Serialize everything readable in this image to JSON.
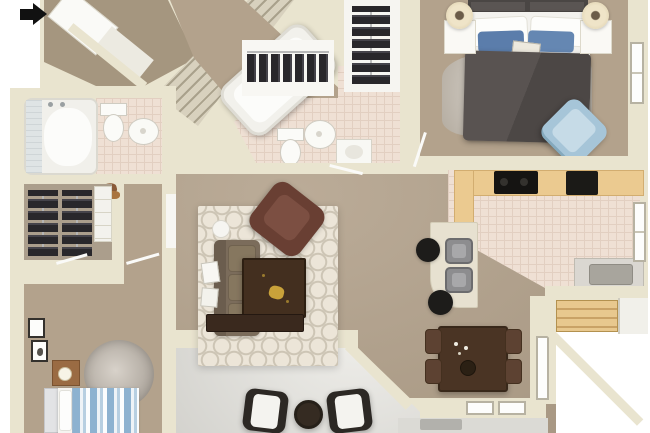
{
  "image": {
    "type": "3d-floor-plan",
    "description": "Top-down 3D architectural rendering of an apartment floor plan; no text labels visible",
    "visible_text": "none"
  },
  "icons": {
    "entry_arrow": "solid black right-pointing arrow marking the unit entry at top-left"
  },
  "palette": {
    "wall": "#e9e4cf",
    "wall_shade": "#d6cfb6",
    "white_wall": "#f7f6f2",
    "carpet": "#b3a28c",
    "carpet_dark": "#a5967f",
    "tile": "#efe0d4",
    "tile_line": "#e2cfc1",
    "patio": "#c9c8c3",
    "wood_counter": "#ebca90",
    "wood_steps": "#e8c88e",
    "dark_wood": "#43301f",
    "duvet": "#555050",
    "pillow_blue": "#5b7dab",
    "chair_blue": "#a6c5d8",
    "sofa": "#7b6c5b",
    "armchair": "#693f33",
    "rug_cream": "#ece5d8",
    "rug_pattern": "#cdc5b5",
    "shag": "#c6bfb7",
    "clothes": "#29272b",
    "appliance": "#151412",
    "arrow": "#111111",
    "glass": "#d9e3e7"
  },
  "rooms": {
    "entry": {
      "label": "Entry"
    },
    "staircase": {
      "label": "Staircase"
    },
    "hallway": {
      "label": "Hallway"
    },
    "closet_a": {
      "label": "Closet with hanging clothes"
    },
    "closet_b": {
      "label": "Closet with hanging clothes"
    },
    "bathroom_upper": {
      "label": "Bathroom with tub, toilet and sinks"
    },
    "master_bedroom": {
      "label": "Bedroom with queen bed and blue chair"
    },
    "kitchen": {
      "label": "Kitchen with wood counters"
    },
    "living_room": {
      "label": "Living room"
    },
    "bathroom_left": {
      "label": "Bathroom with tub, toilet and sink"
    },
    "walk_in_closet": {
      "label": "Walk-in closet"
    },
    "bedroom_2": {
      "label": "Bedroom with striped twin bed"
    },
    "patio": {
      "label": "Patio with two chairs and table"
    },
    "dining_area": {
      "label": "Dining area with table for four"
    },
    "exterior_steps": {
      "label": "Exterior wood steps"
    }
  },
  "furniture": {
    "master_bed": "Bed with dark gray duvet and blue pillows",
    "blue_chair": "Light blue accent chair",
    "shag_rug": "Light gray shag rug",
    "cooktop": "Black cooktop",
    "breakfast_bar": "Breakfast bar with two stools",
    "sofa": "Brown three-seat sofa",
    "armchair": "Dark red-brown armchair",
    "coffee_table": "Dark wood coffee table",
    "trellis_rug": "Cream trellis-pattern area rug",
    "tv_stand": "Dark wood media stand",
    "dining_table": "Dark wood dining table with four chairs",
    "twin_bed": "Blue and white striped twin bed",
    "round_rug": "Round gray shag rug",
    "patio_set": "Two patio chairs with white cushions and round table",
    "bathtub": "Bathtub",
    "toilet": "Toilet",
    "sink": "Pedestal sink"
  }
}
